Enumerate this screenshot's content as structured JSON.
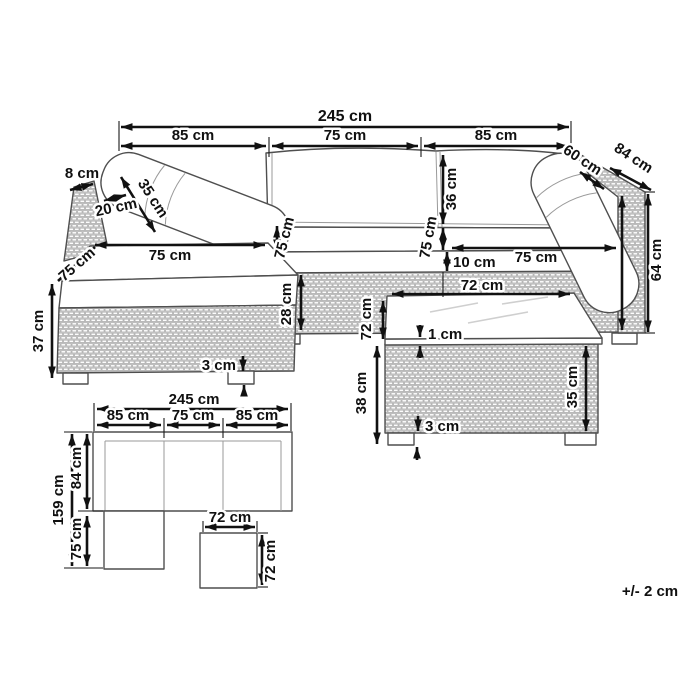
{
  "diagram": {
    "kind": "furniture-dimension-diagram",
    "units": "cm",
    "perspective_view": {
      "top_total": "245 cm",
      "top_left_module": "85 cm",
      "top_center_module": "75 cm",
      "top_right_module": "85 cm",
      "armrest_thickness": "8 cm",
      "corner_cushion_height": "35 cm",
      "corner_cushion_depth": "20 cm",
      "chaise_seat_width": "75 cm",
      "chaise_seat_depth": "75 cm",
      "seam_left_seat_depth": "75 cm",
      "seam_right_seat_depth": "75 cm",
      "backrest_cushion_height": "36 cm",
      "right_back_cushion_width": "60 cm",
      "overall_depth": "84 cm",
      "overall_height": "64 cm",
      "seat_cushion_thickness": "10 cm",
      "right_seat_width": "75 cm",
      "base_height": "28 cm",
      "chaise_height": "37 cm",
      "sofa_foot_height": "3 cm",
      "table_top_width": "72 cm",
      "table_top_depth": "72 cm",
      "glass_thickness": "1 cm",
      "table_height": "38 cm",
      "table_base_height": "35 cm",
      "table_foot_height": "3 cm"
    },
    "plan_view": {
      "total_width": "245 cm",
      "left_module": "85 cm",
      "center_module": "75 cm",
      "right_module": "85 cm",
      "total_depth": "159 cm",
      "sofa_depth": "84 cm",
      "chaise_extension": "75 cm",
      "table_width": "72 cm",
      "table_depth": "72 cm"
    },
    "footer": {
      "tolerance": "+/- 2 cm"
    },
    "colors": {
      "line": "#111111",
      "outline": "#4f4f4f",
      "rattan_stroke": "#b3b3b3",
      "background": "#ffffff"
    }
  }
}
